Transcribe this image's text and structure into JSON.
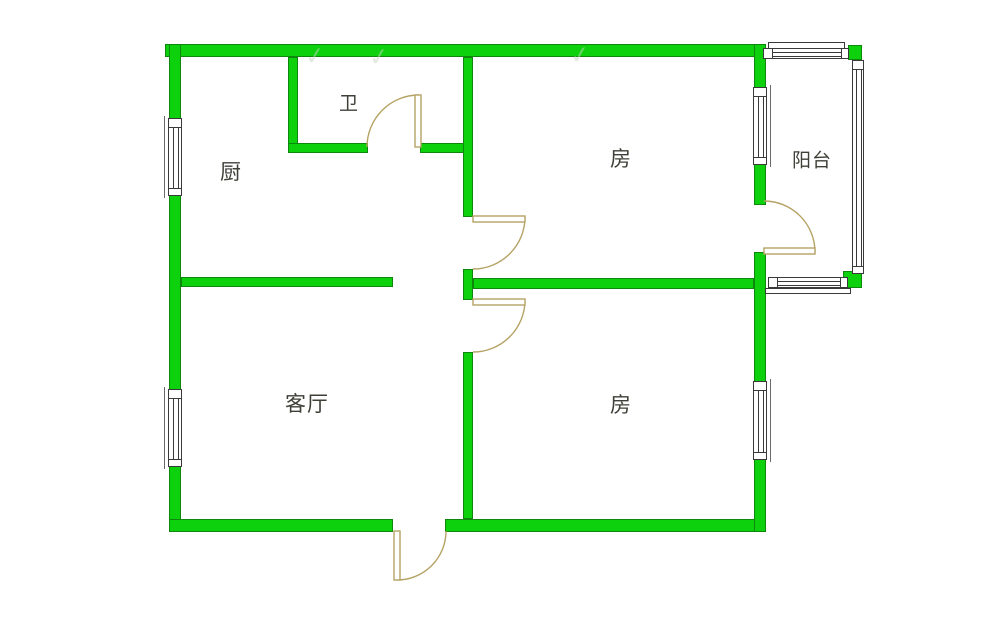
{
  "meta": {
    "type": "apartment-floor-plan",
    "canvas_w": 1000,
    "canvas_h": 634
  },
  "colors": {
    "background": "#ffffff",
    "wall_fill": "#0dd10d",
    "wall_border": "#0d880d",
    "door": "#b5a365",
    "window_line": "#3a3a3a",
    "window_bracket": "#6a6a6a",
    "label_text": "#3f3f37",
    "watermark": "rgba(196,214,192,0.5)"
  },
  "rooms": [
    {
      "id": "kitchen",
      "label": "厨",
      "cx": 231,
      "cy": 171,
      "size": 21
    },
    {
      "id": "bathroom",
      "label": "卫",
      "cx": 349,
      "cy": 102,
      "size": 19
    },
    {
      "id": "bedroom-top",
      "label": "房",
      "cx": 621,
      "cy": 158,
      "size": 21
    },
    {
      "id": "balcony",
      "label": "阳台",
      "cx": 812,
      "cy": 159,
      "size": 19
    },
    {
      "id": "living-room",
      "label": "客厅",
      "cx": 307,
      "cy": 403,
      "size": 21
    },
    {
      "id": "bedroom-bottom",
      "label": "房",
      "cx": 621,
      "cy": 404,
      "size": 21
    }
  ],
  "walls": [
    {
      "id": "wall-exterior-top",
      "x": 165,
      "y": 44,
      "w": 601,
      "h": 13
    },
    {
      "id": "wall-exterior-left",
      "x": 169,
      "y": 44,
      "w": 12,
      "h": 488
    },
    {
      "id": "wall-exterior-bottom-left",
      "x": 169,
      "y": 519,
      "w": 224,
      "h": 13
    },
    {
      "id": "wall-exterior-bottom-right",
      "x": 445,
      "y": 519,
      "w": 321,
      "h": 13
    },
    {
      "id": "wall-exterior-right-upper",
      "x": 754,
      "y": 44,
      "w": 12,
      "h": 161
    },
    {
      "id": "wall-exterior-right-lower",
      "x": 754,
      "y": 252,
      "w": 12,
      "h": 280
    },
    {
      "id": "wall-bathroom-left",
      "x": 288,
      "y": 57,
      "w": 10,
      "h": 96
    },
    {
      "id": "wall-bathroom-bottom-west",
      "x": 288,
      "y": 143,
      "w": 80,
      "h": 10
    },
    {
      "id": "wall-bathroom-bottom-east",
      "x": 420,
      "y": 143,
      "w": 53,
      "h": 10
    },
    {
      "id": "wall-central-upper",
      "x": 463,
      "y": 57,
      "w": 10,
      "h": 160
    },
    {
      "id": "wall-central-middle",
      "x": 463,
      "y": 269,
      "w": 10,
      "h": 31
    },
    {
      "id": "wall-central-lower",
      "x": 463,
      "y": 352,
      "w": 10,
      "h": 167
    },
    {
      "id": "wall-divider-kitchen-living",
      "x": 181,
      "y": 277,
      "w": 212,
      "h": 10
    },
    {
      "id": "wall-divider-bedrooms",
      "x": 473,
      "y": 278,
      "w": 281,
      "h": 11
    },
    {
      "id": "wall-balcony-corner-top",
      "x": 848,
      "y": 45,
      "w": 14,
      "h": 15
    },
    {
      "id": "wall-balcony-corner-bottom",
      "x": 843,
      "y": 271,
      "w": 19,
      "h": 17
    }
  ],
  "windows": [
    {
      "id": "window-kitchen-left",
      "dir": "v",
      "x": 168,
      "y": 118,
      "len": 78,
      "thick": 14,
      "bracket": "left"
    },
    {
      "id": "window-living-left",
      "dir": "v",
      "x": 168,
      "y": 389,
      "len": 78,
      "thick": 14,
      "bracket": "left"
    },
    {
      "id": "window-bedroom-top-right",
      "dir": "v",
      "x": 753,
      "y": 87,
      "len": 78,
      "thick": 14,
      "bracket": "right"
    },
    {
      "id": "window-bedroom-bot-right",
      "dir": "v",
      "x": 753,
      "y": 381,
      "len": 79,
      "thick": 14,
      "bracket": "right"
    },
    {
      "id": "window-balcony-top",
      "dir": "h",
      "x": 763,
      "y": 48,
      "len": 86,
      "thick": 11,
      "bracket": "none"
    },
    {
      "id": "window-balcony-right",
      "dir": "v",
      "x": 852,
      "y": 60,
      "len": 214,
      "thick": 12,
      "bracket": "none"
    },
    {
      "id": "window-balcony-bottom",
      "dir": "h",
      "x": 768,
      "y": 277,
      "len": 80,
      "thick": 11,
      "bracket": "none"
    }
  ],
  "window_frames": [
    {
      "id": "frame-balcony-top-lintel",
      "x": 768,
      "y": 42,
      "w": 77,
      "h": 7
    },
    {
      "id": "frame-balcony-bottom-sill",
      "x": 765,
      "y": 288,
      "w": 86,
      "h": 6
    }
  ],
  "doors": [
    {
      "id": "door-bathroom",
      "panel": {
        "x": 415,
        "y": 95,
        "w": 6,
        "h": 52
      },
      "arc": "M 367 147 A 52 52 0 0 1 419 95"
    },
    {
      "id": "door-bedroom-top",
      "panel": {
        "x": 473,
        "y": 216,
        "w": 52,
        "h": 6
      },
      "arc": "M 525 217 A 52 52 0 0 1 473 269"
    },
    {
      "id": "door-bedroom-bottom",
      "panel": {
        "x": 473,
        "y": 299,
        "w": 52,
        "h": 6
      },
      "arc": "M 525 300 A 52 52 0 0 1 473 352"
    },
    {
      "id": "door-balcony",
      "panel": {
        "x": 764,
        "y": 248,
        "w": 51,
        "h": 6
      },
      "arc": "M 815 252 A 51 51 0 0 0 764 201"
    },
    {
      "id": "door-entrance",
      "panel": {
        "x": 394,
        "y": 531,
        "w": 6,
        "h": 49
      },
      "arc": "M 397 580 A 49 49 0 0 0 446 531"
    }
  ],
  "watermarks": [
    {
      "glyph": "✓",
      "x": 315,
      "y": 56
    },
    {
      "glyph": "✓",
      "x": 379,
      "y": 57
    },
    {
      "glyph": "✓",
      "x": 580,
      "y": 55
    }
  ]
}
